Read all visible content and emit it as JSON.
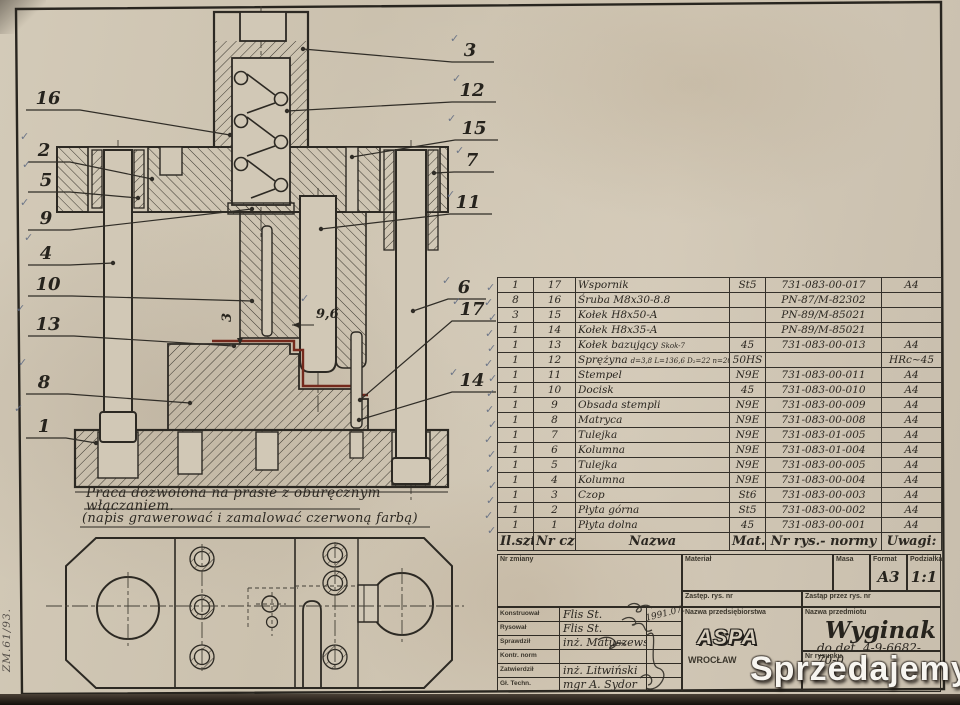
{
  "notes": {
    "l1": "Praca dozwolona na prasie z oburęcznym",
    "l2": "włączaniem.",
    "l3": "(napis grawerować i zamalować czerwoną farbą)"
  },
  "edge_text": "ZM.61/93.",
  "marks": {
    "check": "✓"
  },
  "dims": {
    "gap": "9,6",
    "depth": "3"
  },
  "callouts": {
    "left": [
      "16",
      "2",
      "5",
      "9",
      "4",
      "10",
      "13",
      "8",
      "1"
    ],
    "right": [
      "3",
      "12",
      "15",
      "7",
      "11",
      "6",
      "17",
      "14"
    ]
  },
  "parts_table": {
    "rows": [
      {
        "q": "1",
        "n": "17",
        "nm": "Wspornik",
        "mt": "St5",
        "nr": "731-083-00-017",
        "rm": "A4"
      },
      {
        "q": "8",
        "n": "16",
        "nm": "Śruba M8x30-8.8",
        "mt": "",
        "nr": "PN-87/M-82302",
        "rm": ""
      },
      {
        "q": "3",
        "n": "15",
        "nm": "Kołek H8x50-A",
        "mt": "",
        "nr": "PN-89/M-85021",
        "rm": ""
      },
      {
        "q": "1",
        "n": "14",
        "nm": "Kołek H8x35-A",
        "mt": "",
        "nr": "PN-89/M-85021",
        "rm": ""
      },
      {
        "q": "1",
        "n": "13",
        "nm": "Kołek bazujący",
        "nt": "Skok-7",
        "mt": "45",
        "nr": "731-083-00-013",
        "rm": "A4"
      },
      {
        "q": "1",
        "n": "12",
        "nm": "Sprężyna",
        "nt": "d=3,8 L=136,6 D₂=22 n=20,5 ncz=19",
        "mt": "50HS",
        "nr": "",
        "rm": "HRc~45"
      },
      {
        "q": "1",
        "n": "11",
        "nm": "Stempel",
        "mt": "N9E",
        "nr": "731-083-00-011",
        "rm": "A4"
      },
      {
        "q": "1",
        "n": "10",
        "nm": "Docisk",
        "mt": "45",
        "nr": "731-083-00-010",
        "rm": "A4"
      },
      {
        "q": "1",
        "n": "9",
        "nm": "Obsada stempli",
        "mt": "N9E",
        "nr": "731-083-00-009",
        "rm": "A4"
      },
      {
        "q": "1",
        "n": "8",
        "nm": "Matryca",
        "mt": "N9E",
        "nr": "731-083-00-008",
        "rm": "A4"
      },
      {
        "q": "1",
        "n": "7",
        "nm": "Tulejka",
        "mt": "N9E",
        "nr": "731-083-01-005",
        "rm": "A4"
      },
      {
        "q": "1",
        "n": "6",
        "nm": "Kolumna",
        "mt": "N9E",
        "nr": "731-083-01-004",
        "rm": "A4"
      },
      {
        "q": "1",
        "n": "5",
        "nm": "Tulejka",
        "mt": "N9E",
        "nr": "731-083-00-005",
        "rm": "A4"
      },
      {
        "q": "1",
        "n": "4",
        "nm": "Kolumna",
        "mt": "N9E",
        "nr": "731-083-00-004",
        "rm": "A4"
      },
      {
        "q": "1",
        "n": "3",
        "nm": "Czop",
        "mt": "St6",
        "nr": "731-083-00-003",
        "rm": "A4"
      },
      {
        "q": "1",
        "n": "2",
        "nm": "Płyta górna",
        "mt": "St5",
        "nr": "731-083-00-002",
        "rm": "A4"
      },
      {
        "q": "1",
        "n": "1",
        "nm": "Płyta dolna",
        "mt": "45",
        "nr": "731-083-00-001",
        "rm": "A4"
      }
    ],
    "footer": {
      "qty": "Il.szt.",
      "part": "Nr cz.",
      "name": "Nazwa",
      "mat": "Mat.",
      "norm": "Nr rys.- normy",
      "rem": "Uwagi:"
    }
  },
  "title_block": {
    "nr_zmiany_label": "Nr zmiany",
    "material_label": "Materiał",
    "masa_label": "Masa",
    "format_label": "Format",
    "format_value": "A3",
    "podzialka_label": "Podziałka",
    "podzialka_value": "1:1",
    "zastep_label": "Zastęp. rys. nr",
    "zastap_label": "Zastąp przez rys. nr",
    "roles": [
      {
        "label": "Konstruował",
        "value": "Flis St."
      },
      {
        "label": "Rysował",
        "value": "Flis St."
      },
      {
        "label": "Sprawdził",
        "value": "inż. Matuszewski"
      },
      {
        "label": "Kontr. norm",
        "value": ""
      },
      {
        "label": "Zatwierdził",
        "value": "inż. Litwiński"
      },
      {
        "label": "Gł. Techn.",
        "value": "mgr A. Sydor"
      }
    ],
    "date_note": "1991.07.",
    "company_label": "Nazwa przedsiębiorstwa",
    "company_logo": "ASPA",
    "company_city": "WROCŁAW",
    "subject_label": "Nazwa przedmiotu",
    "subject_name": "Wyginak",
    "subject_detail": "do det. 4-9-6682-70-0",
    "drawing_nr_label": "Nr rysunku"
  },
  "watermark": {
    "text": "Sprzedajemy",
    "badge": ".pl",
    "accent": "#ee7a14"
  }
}
